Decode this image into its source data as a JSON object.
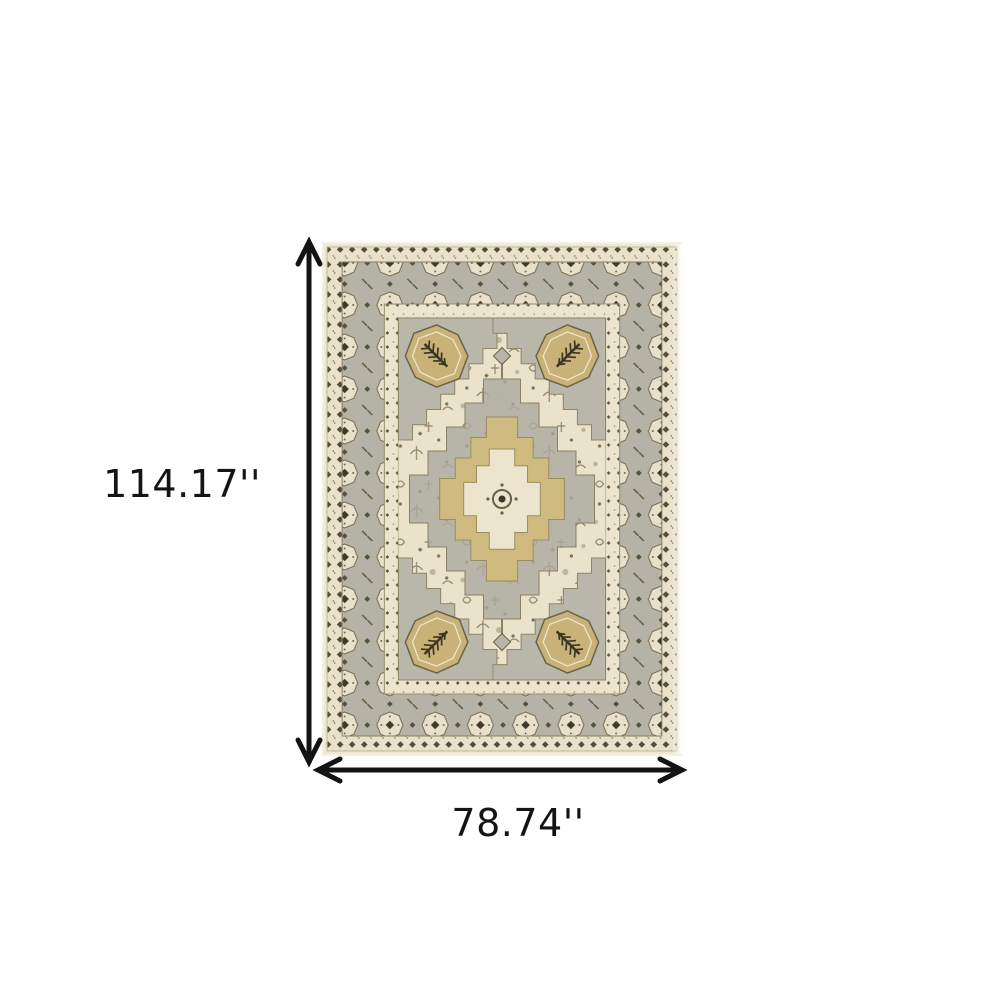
{
  "page": {
    "background_color": "#ffffff"
  },
  "diagram": {
    "height_label": "114.17''",
    "width_label": "78.74''",
    "arrow_color": "#131313",
    "label_color": "#141414"
  },
  "rug": {
    "semantic": "oriental-medallion-area-rug-photo",
    "colors": {
      "photo_bg": "#f5f0e3",
      "selvedge": "#efe8d5",
      "guard_cream": "#e9e1cb",
      "border_gray": "#b5b2a6",
      "field": "#ebe2cb",
      "spandrel_gray": "#b9b6aa",
      "cartouche_gold": "#c9b277",
      "medallion_gray": "#b7b4a8",
      "medallion_tan": "#cfba80",
      "medallion_cream": "#ece4cd",
      "motif_dark": "#3e392a"
    }
  }
}
